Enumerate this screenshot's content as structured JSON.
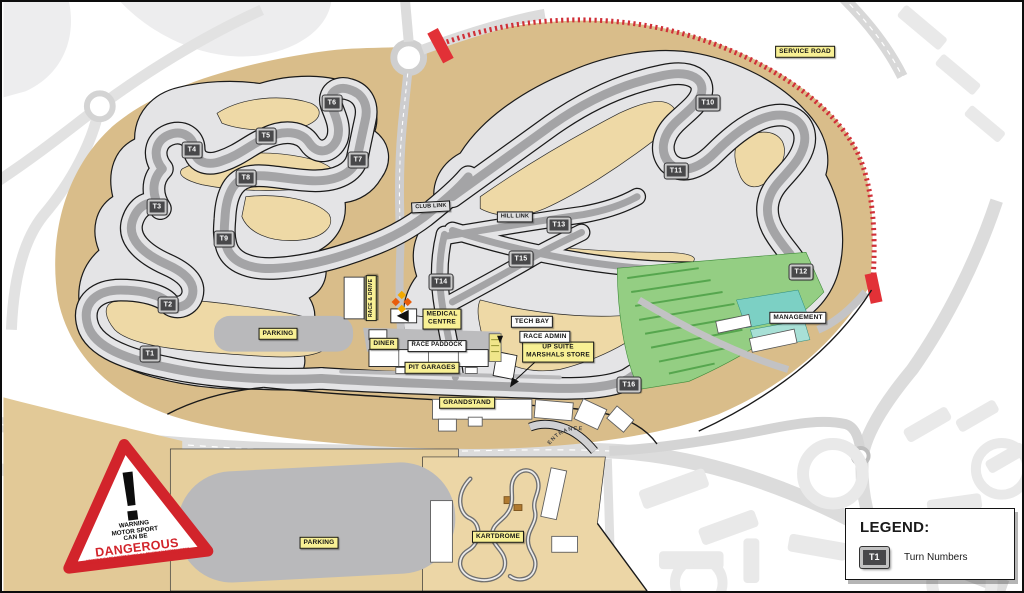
{
  "colors": {
    "site_tan": "#d9bd8a",
    "infield_tan": "#eed9a6",
    "runoff_silver": "#e4e4e6",
    "track_gray": "#a4a4a6",
    "label_yellow": "#f8f094",
    "service_road_red": "#d03038",
    "warning_red": "#d2242b",
    "landscape_green": "#94ce83"
  },
  "legend": {
    "title": "LEGEND:",
    "sample_marker": "T1",
    "item": "Turn Numbers"
  },
  "warning_sign": {
    "exclamation": "!",
    "heading_lines": [
      "WARNING",
      "MOTOR SPORT",
      "CAN BE"
    ],
    "danger_word": "DANGEROUS",
    "fine_print": [
      "DESPITE THE ORGANISERS TAKING ALL REASONABLE PRECAUTIONS",
      "UNAVOIDABLE ACCIDENTS CAN HAPPEN. YOU ARE PRESENT AT YOUR OWN RISK"
    ]
  },
  "entrance_label": "ENTRANCE",
  "turn_markers": [
    {
      "id": "T1",
      "x": 148,
      "y": 352
    },
    {
      "id": "T2",
      "x": 166,
      "y": 303
    },
    {
      "id": "T3",
      "x": 155,
      "y": 205
    },
    {
      "id": "T4",
      "x": 190,
      "y": 148
    },
    {
      "id": "T5",
      "x": 264,
      "y": 134
    },
    {
      "id": "T6",
      "x": 330,
      "y": 101
    },
    {
      "id": "T7",
      "x": 356,
      "y": 158
    },
    {
      "id": "T8",
      "x": 244,
      "y": 176
    },
    {
      "id": "T9",
      "x": 222,
      "y": 237
    },
    {
      "id": "T10",
      "x": 706,
      "y": 101
    },
    {
      "id": "T11",
      "x": 674,
      "y": 169
    },
    {
      "id": "T12",
      "x": 799,
      "y": 270
    },
    {
      "id": "T13",
      "x": 557,
      "y": 223
    },
    {
      "id": "T14",
      "x": 439,
      "y": 280
    },
    {
      "id": "T15",
      "x": 519,
      "y": 257
    },
    {
      "id": "T16",
      "x": 627,
      "y": 383
    }
  ],
  "labels": [
    {
      "slug": "service-road",
      "text": "SERVICE ROAD",
      "x": 803,
      "y": 50,
      "style": "yellow"
    },
    {
      "slug": "parking-west",
      "text": "PARKING",
      "x": 276,
      "y": 332,
      "style": "yellow"
    },
    {
      "slug": "parking-south",
      "text": "PARKING",
      "x": 317,
      "y": 541,
      "style": "yellow"
    },
    {
      "slug": "medical-centre",
      "text": "MEDICAL\nCENTRE",
      "x": 440,
      "y": 317,
      "style": "yellow"
    },
    {
      "slug": "diner",
      "text": "DINER",
      "x": 382,
      "y": 342,
      "style": "yellow"
    },
    {
      "slug": "pit-garages",
      "text": "PIT GARAGES",
      "x": 430,
      "y": 366,
      "style": "yellow"
    },
    {
      "slug": "up-suite",
      "text": "UP SUITE\nMARSHALS STORE",
      "x": 556,
      "y": 350,
      "style": "yellow"
    },
    {
      "slug": "grandstand",
      "text": "GRANDSTAND",
      "x": 465,
      "y": 401,
      "style": "yellow"
    },
    {
      "slug": "kartdrome",
      "text": "KARTDROME",
      "x": 496,
      "y": 535,
      "style": "yellow"
    },
    {
      "slug": "race-and-drive",
      "text": "RACE & DRIVE",
      "x": 369,
      "y": 296,
      "style": "yellow",
      "rot": -90,
      "fs": 5
    },
    {
      "slug": "race-paddock",
      "text": "RACE PADDOCK",
      "x": 435,
      "y": 344,
      "style": "white",
      "fs": 6
    },
    {
      "slug": "tech-bay",
      "text": "TECH BAY",
      "x": 530,
      "y": 320,
      "style": "white"
    },
    {
      "slug": "race-admin",
      "text": "RACE ADMIN",
      "x": 543,
      "y": 335,
      "style": "white"
    },
    {
      "slug": "management",
      "text": "MANAGEMENT",
      "x": 796,
      "y": 316,
      "style": "white"
    },
    {
      "slug": "club-link",
      "text": "CLUB LINK",
      "x": 429,
      "y": 205,
      "style": "silver",
      "fs": 5.5,
      "rot": -3
    },
    {
      "slug": "hill-link",
      "text": "HILL LINK",
      "x": 513,
      "y": 215,
      "style": "silver",
      "fs": 5.5
    }
  ]
}
